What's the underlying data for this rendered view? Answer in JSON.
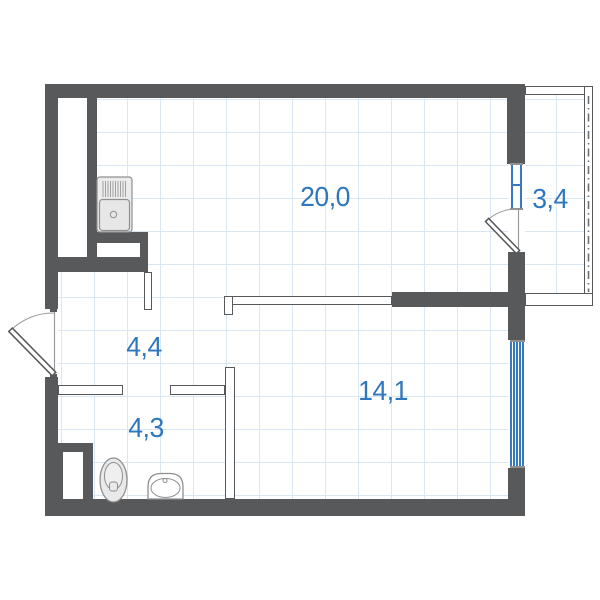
{
  "plan": {
    "title": "studio-apartment-floor-plan",
    "rooms": [
      {
        "id": "living-kitchen",
        "area_label": "20,0"
      },
      {
        "id": "balcony",
        "area_label": "3,4"
      },
      {
        "id": "hallway",
        "area_label": "4,4"
      },
      {
        "id": "bathroom",
        "area_label": "4,3"
      },
      {
        "id": "bedroom",
        "area_label": "14,1"
      }
    ],
    "fixtures": [
      {
        "icon": "kitchen-sink-icon"
      },
      {
        "icon": "toilet-icon"
      },
      {
        "icon": "washbasin-icon"
      },
      {
        "icon": "entrance-door-icon"
      },
      {
        "icon": "balcony-door-icon"
      }
    ],
    "colors": {
      "wall": "#58595b",
      "window_blue": "#3679be",
      "label_blue": "#2e77bd",
      "grid_blue": "#d9e7f5",
      "fixture_gray": "#8f8f8f"
    }
  }
}
